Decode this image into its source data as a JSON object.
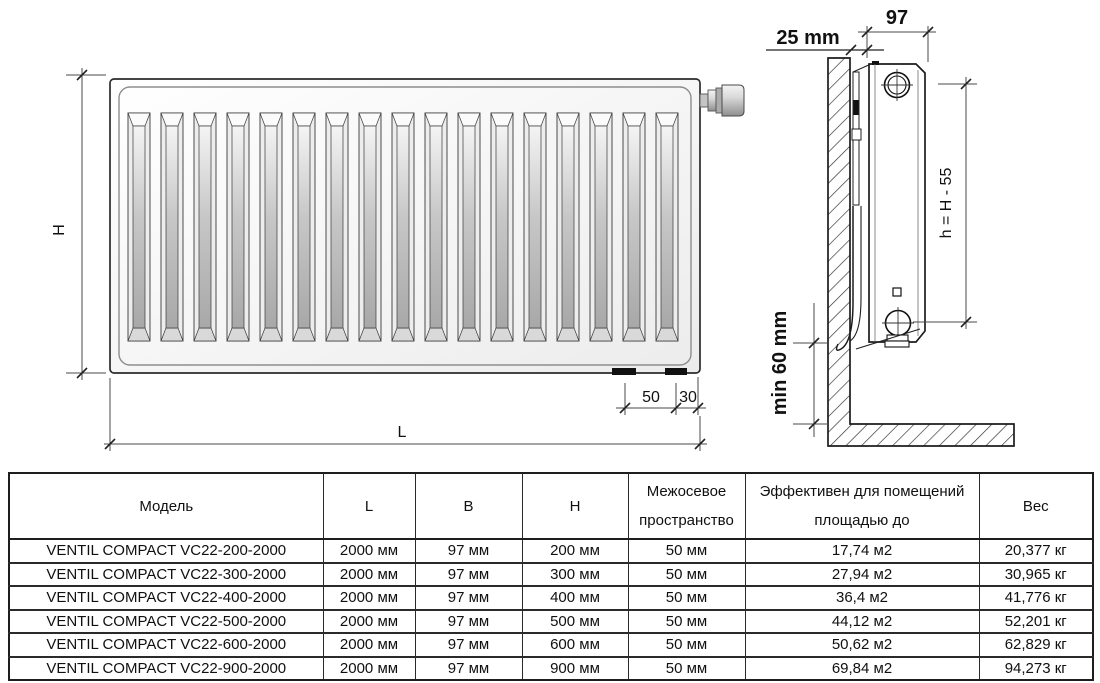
{
  "diagram": {
    "front_view": {
      "height_label": "H",
      "length_label": "L",
      "offset_50": "50",
      "offset_30": "30"
    },
    "side_view": {
      "depth_label": "97",
      "wall_gap_label": "25 mm",
      "axis_height_label": "h = H - 55",
      "floor_clearance_label": "min 60 mm"
    },
    "slat_count": 17
  },
  "table": {
    "headers": [
      "Модель",
      "L",
      "B",
      "H",
      "Межосевое пространство",
      "Эффективен для помещений площадью до",
      "Вес"
    ],
    "rows": [
      [
        "VENTIL COMPACT VC22-200-2000",
        "2000 мм",
        "97 мм",
        "200 мм",
        "50 мм",
        "17,74 м2",
        "20,377 кг"
      ],
      [
        "VENTIL COMPACT VC22-300-2000",
        "2000 мм",
        "97 мм",
        "300 мм",
        "50 мм",
        "27,94 м2",
        "30,965 кг"
      ],
      [
        "VENTIL COMPACT VC22-400-2000",
        "2000 мм",
        "97 мм",
        "400 мм",
        "50 мм",
        "36,4 м2",
        "41,776 кг"
      ],
      [
        "VENTIL COMPACT VC22-500-2000",
        "2000 мм",
        "97 мм",
        "500 мм",
        "50 мм",
        "44,12 м2",
        "52,201 кг"
      ],
      [
        "VENTIL COMPACT VC22-600-2000",
        "2000 мм",
        "97 мм",
        "600 мм",
        "50 мм",
        "50,62 м2",
        "62,829 кг"
      ],
      [
        "VENTIL COMPACT VC22-900-2000",
        "2000 мм",
        "97 мм",
        "900 мм",
        "50 мм",
        "69,84 м2",
        "94,273 кг"
      ]
    ]
  },
  "colors": {
    "ink": "#111111",
    "dim_line": "#4a4a4a"
  }
}
